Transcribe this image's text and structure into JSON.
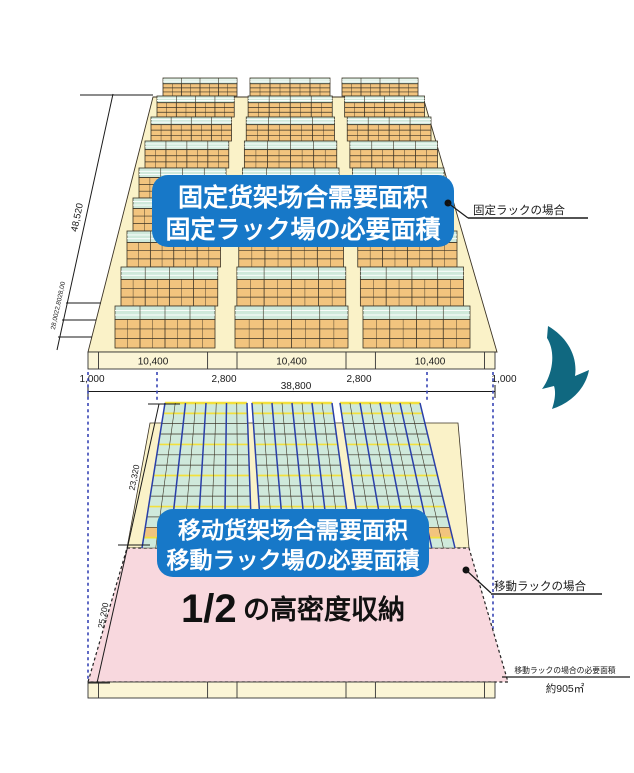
{
  "top_diagram": {
    "badge_line1": "固定货架场合需要面积",
    "badge_line2": "固定ラック場の必要面積",
    "callout_label": "固定ラックの場合",
    "dim_depth_total": "48,520",
    "dim_depth_rows": "28,0022,8028,00",
    "base_segment_labels": [
      "10,400",
      "10,400",
      "10,400"
    ],
    "dim_left_margin": "1,000",
    "dim_aisle_left": "2,800",
    "dim_total_width": "38,800",
    "dim_aisle_right": "2,800",
    "dim_right_margin": "1,000"
  },
  "bottom_diagram": {
    "badge_line1": "移动货架场合需要面积",
    "badge_line2": "移動ラック場の必要面積",
    "density_fraction": "1/2",
    "density_label": "の高密度収納",
    "callout_label": "移動ラックの場合",
    "dim_rack_depth": "23,320",
    "dim_floor_depth": "25,200",
    "note_title": "移動ラックの場合の必要面積",
    "note_value": "約905㎡"
  },
  "colors": {
    "badge_blue": "#1778c8",
    "floor_cream": "#faf2c8",
    "base_strip_cream": "#fbf5d6",
    "rack_orange": "#f2c47e",
    "rack_top_teal": "#cfe9db",
    "pink_area": "#f8d8de",
    "arrow_teal": "#106880",
    "guide_blue": "#3845b5",
    "rail_yellow": "#f2e03c",
    "block_line_blue": "#2a3fa8",
    "outline_dark": "#3b3325"
  }
}
